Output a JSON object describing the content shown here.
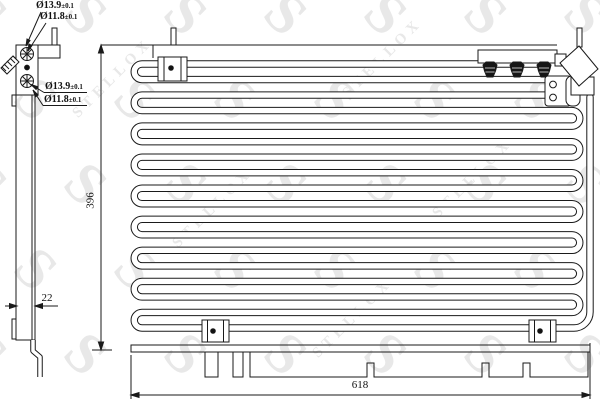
{
  "watermark": {
    "glyph": "S",
    "brand": "STELLOX",
    "color": "#d9d9d9"
  },
  "line_color": "#1a1a1a",
  "port_labels": [
    {
      "dia": "Ø13.9",
      "tol": "±0.1"
    },
    {
      "dia": "Ø11.8",
      "tol": "±0.1"
    },
    {
      "dia": "Ø13.9",
      "tol": "±0.1"
    },
    {
      "dia": "Ø11.8",
      "tol": "±0.1"
    }
  ],
  "dimensions": {
    "height": "396",
    "depth": "22",
    "width": "618"
  }
}
